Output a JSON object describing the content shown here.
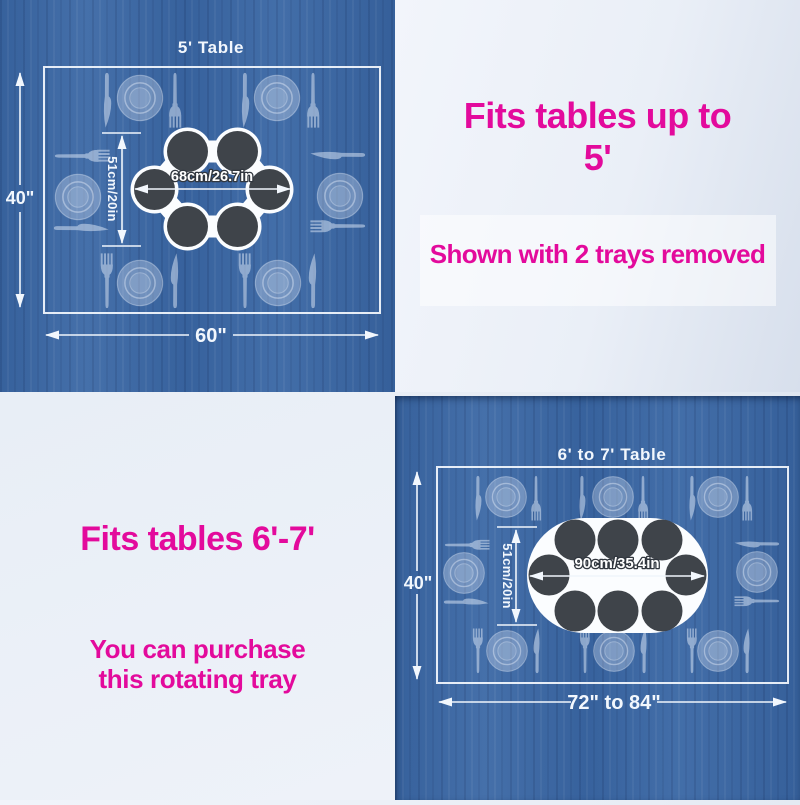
{
  "colors": {
    "wood_blue": "#3b68a5",
    "panel_light": "#e9eef6",
    "accent_pink": "#e30a9c",
    "diagram_line_white": "#f2f7fd",
    "tray_dish_dark": "#3f444a"
  },
  "icons": {
    "plate": "plate-icon",
    "fork": "fork-icon",
    "knife": "knife-icon",
    "tray": "rotating-tray"
  },
  "diagram_5ft": {
    "title": "5' Table",
    "height_label": "40\"",
    "width_label": "60\"",
    "tray_width_label": "68cm/26.7in",
    "tray_height_label": "51cm/20in"
  },
  "panel_top_right": {
    "heading_line1": "Fits tables up to",
    "heading_line2": "5'",
    "note": "Shown with 2 trays removed"
  },
  "panel_bottom_left": {
    "heading": "Fits tables 6'-7'",
    "note_line1": "You can purchase",
    "note_line2": "this rotating tray"
  },
  "diagram_6_7ft": {
    "title": "6' to 7' Table",
    "height_label": "40\"",
    "width_label": "72\" to 84\"",
    "tray_width_label": "90cm/35.4in",
    "tray_height_label": "51cm/20in"
  }
}
